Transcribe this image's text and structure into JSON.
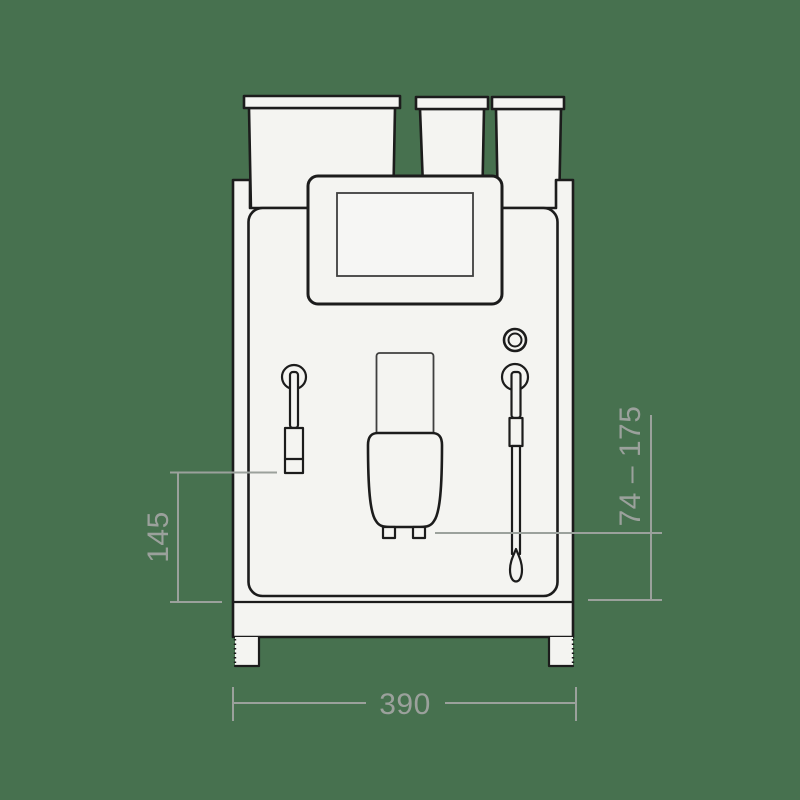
{
  "diagram": {
    "view": "coffee-machine-front-elevation",
    "dimensions": {
      "left_height": "145",
      "spout_height_range": "74 – 175",
      "width": "390"
    }
  },
  "colors": {
    "bg": "#47714F",
    "line": "#1c1c1c",
    "fill": "#f4f4f1",
    "screen_fill": "#f6f6f4",
    "screen_line": "#3f3f3f",
    "dim": "#9ba19c"
  }
}
